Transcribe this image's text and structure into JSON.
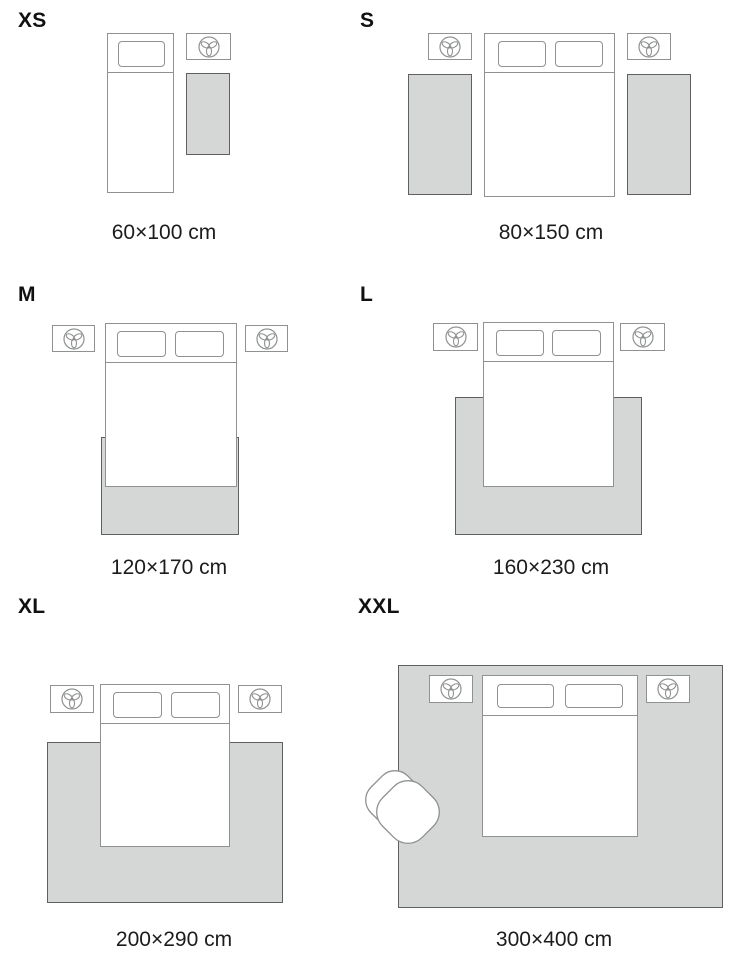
{
  "guide": {
    "type": "rug-size-guide",
    "panels": [
      {
        "size_label": "XS",
        "rug_dimensions": "60×100 cm",
        "scene": "single bed, one nightstand with plant, bedside rug"
      },
      {
        "size_label": "S",
        "rug_dimensions": "80×150 cm",
        "scene": "double bed, two nightstands with plants, two bedside rugs"
      },
      {
        "size_label": "M",
        "rug_dimensions": "120×170 cm",
        "scene": "double bed, two nightstands with plants, rug under foot of bed"
      },
      {
        "size_label": "L",
        "rug_dimensions": "160×230 cm",
        "scene": "double bed, two nightstands with plants, larger rug under lower bed"
      },
      {
        "size_label": "XL",
        "rug_dimensions": "200×290 cm",
        "scene": "double bed, two nightstands with plants, wide rug under lower bed"
      },
      {
        "size_label": "XXL",
        "rug_dimensions": "300×400 cm",
        "scene": "room-size rug under double bed, two nightstands with plants, armchair"
      }
    ],
    "colors": {
      "background": "#ffffff",
      "rug_fill": "#d5d6d6",
      "rug_border": "#5e6062",
      "furniture_outline": "#8f9192",
      "text": "#1c1c1c"
    },
    "icons": {
      "nightstand_decor": "plant-icon",
      "seat": "armchair"
    }
  }
}
